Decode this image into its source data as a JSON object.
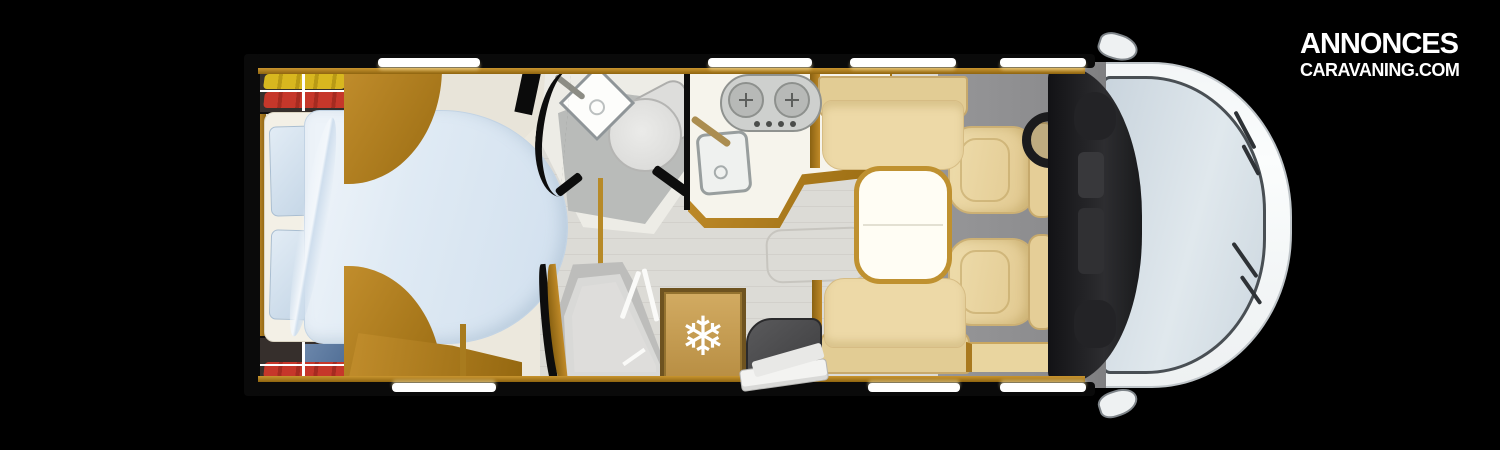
{
  "brand": {
    "line1": "ANNONCES",
    "line2": "CARAVANING.COM"
  },
  "icons": {
    "fridge_snowflake": "❄"
  },
  "diagram": {
    "type": "motorhome-floorplan-top-view",
    "orientation": "front-on-right, rear-on-left",
    "zones": [
      {
        "name": "rear-bedroom",
        "items": [
          "island-double-bed",
          "duvet",
          "two-pillows",
          "wardrobe-with-clothes-top",
          "wardrobe-with-clothes-bottom",
          "wood-cabinets",
          "foot-bench"
        ]
      },
      {
        "name": "bathroom",
        "items": [
          "corner-washbasin",
          "faucet",
          "toilet",
          "pivot-door"
        ]
      },
      {
        "name": "shower-room",
        "items": [
          "shower-tray",
          "folding-door"
        ]
      },
      {
        "name": "kitchen",
        "items": [
          "two-burner-hob",
          "sink-with-faucet",
          "worktop"
        ]
      },
      {
        "name": "refrigerator",
        "items": [
          "fridge-with-snowflake-icon"
        ]
      },
      {
        "name": "dinette",
        "items": [
          "table",
          "bench-seat-kitchen-side",
          "bench-seat-door-side"
        ]
      },
      {
        "name": "entry",
        "items": [
          "entrance-landing",
          "fold-out-step"
        ]
      },
      {
        "name": "cab",
        "items": [
          "driver-swivel-seat",
          "passenger-swivel-seat",
          "steering-wheel",
          "dashboard",
          "windshield",
          "wipers",
          "side-mirror-left",
          "side-mirror-right"
        ]
      }
    ],
    "palette": {
      "background": "#000000",
      "wood": "#b9861f",
      "upholstery": "#e9d6a4",
      "bedding": "#dfe9f4",
      "floor_cream": "#ece8dd",
      "floor_light": "#dcdbd6",
      "floor_gray": "#8d8d8f",
      "cab_body": "#f8fafa",
      "windshield": "#d4dfe7",
      "dashboard": "#28282b",
      "clothes_accents": [
        "#d8b71f",
        "#c6372a",
        "#5d7ba3"
      ]
    }
  }
}
